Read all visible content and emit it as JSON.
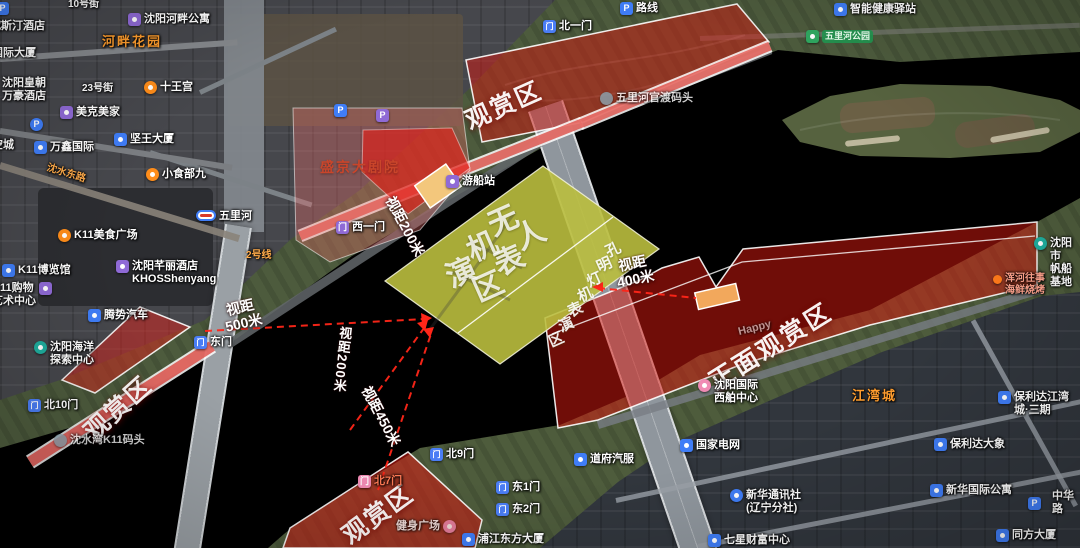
{
  "map": {
    "zones": {
      "top_viewing": {
        "label": "观赏区"
      },
      "west_viewing": {
        "label": "观赏区"
      },
      "south_viewing": {
        "label": "观赏区"
      },
      "front_viewing": {
        "label": "正面观赏区"
      },
      "drone_area": {
        "label": "无人机表演区"
      },
      "lantern_area": {
        "label": "孔明灯机表演区"
      },
      "theater": {
        "label": "盛京大剧院"
      }
    },
    "distances": [
      {
        "label": "视距",
        "value": "500米"
      },
      {
        "label": "视距",
        "value": "200米"
      },
      {
        "label": "视距",
        "value": "450米"
      },
      {
        "label": "视距",
        "value": "200米"
      },
      {
        "label": "视距",
        "value": "400米"
      }
    ],
    "gates": [
      {
        "label": "北一门"
      },
      {
        "label": "西一门"
      },
      {
        "label": "东门"
      },
      {
        "label": "北10门"
      },
      {
        "label": "北9门"
      },
      {
        "label": "北7门"
      },
      {
        "label": "东1门"
      },
      {
        "label": "东2门"
      }
    ],
    "pois": [
      {
        "label": "路线",
        "icon": "parking"
      },
      {
        "label": "智能健康驿站",
        "icon": "health"
      },
      {
        "label": "五里河公园",
        "icon": "park"
      },
      {
        "label": "威斯汀酒店"
      },
      {
        "label": "国际大厦"
      },
      {
        "label": "沈阳皇朝\n万豪酒店"
      },
      {
        "label": "河畔花园"
      },
      {
        "label": "沈阳河畔公寓",
        "icon": "apartment"
      },
      {
        "label": "十王宫",
        "icon": "scenic"
      },
      {
        "label": "美克美家",
        "icon": "shop"
      },
      {
        "label": "万鑫国际",
        "icon": "building"
      },
      {
        "label": "坚王大厦",
        "icon": "building"
      },
      {
        "label": "空城"
      },
      {
        "label": "小食部九",
        "icon": "food"
      },
      {
        "label": "五里河",
        "icon": "metro-station"
      },
      {
        "label": "K11美食广场",
        "icon": "food"
      },
      {
        "label": "K11博览馆",
        "icon": "building"
      },
      {
        "label": "沈阳芊丽酒店\nKHOSShenyang",
        "icon": "hotel"
      },
      {
        "label": "K11购物\n艺术中心",
        "icon": "shop"
      },
      {
        "label": "腾势汽车",
        "icon": "car"
      },
      {
        "label": "沈阳海洋\n探索中心",
        "icon": "attraction"
      },
      {
        "label": "沈水湾K11码头",
        "icon": "wharf"
      },
      {
        "label": "游船站",
        "icon": "wharf"
      },
      {
        "label": "五里河官渡码头",
        "icon": "wharf"
      },
      {
        "label": "健身广场",
        "icon": "sport"
      },
      {
        "label": "浦江东方大厦",
        "icon": "building"
      },
      {
        "label": "道府汽服",
        "icon": "car"
      },
      {
        "label": "国家电网",
        "icon": "building"
      },
      {
        "label": "Happy"
      },
      {
        "label": "沈阳国际\n西舶中心",
        "icon": "wharf"
      },
      {
        "label": "江湾城"
      },
      {
        "label": "保利达江湾\n城·三期",
        "icon": "building"
      },
      {
        "label": "保利达大象",
        "icon": "building"
      },
      {
        "label": "新华国际公寓",
        "icon": "building"
      },
      {
        "label": "新华通讯社\n(辽宁分社)",
        "icon": "office"
      },
      {
        "label": "七星财富中心",
        "icon": "building"
      },
      {
        "label": "同方大厦",
        "icon": "building"
      },
      {
        "label": "中华路"
      },
      {
        "label": "浑河往事\n海鲜烧烤",
        "icon": "restaurant"
      },
      {
        "label": "沈阳市\n帆船基地",
        "icon": "marina"
      }
    ],
    "roads": [
      {
        "label": "10号街"
      },
      {
        "label": "23号街"
      },
      {
        "label": "2号线"
      },
      {
        "label": "沈水东路"
      }
    ],
    "icon_glyphs": {
      "parking": "P",
      "gate": "门"
    },
    "colors": {
      "viewing_zone_red": "#d61810",
      "performance_zone_olive": "#babd3e",
      "stage_orange": "#f2b269",
      "sightline_red": "#ff2619",
      "water": "#27312b"
    }
  }
}
